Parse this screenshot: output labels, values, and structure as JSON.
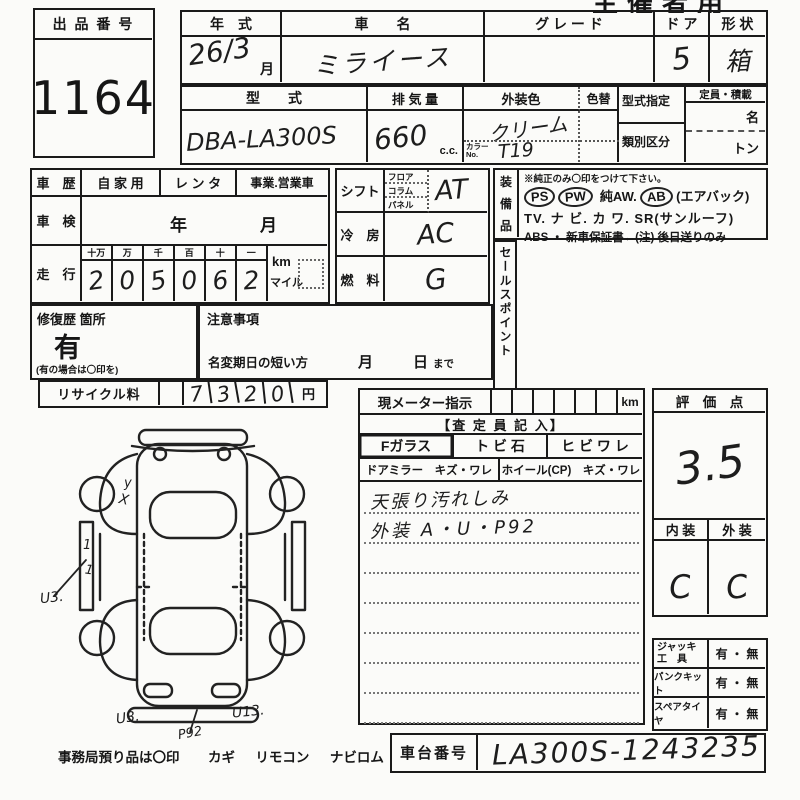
{
  "corner": {
    "label": "主催者用"
  },
  "lot": {
    "label": "出 品 番 号",
    "number": "1164"
  },
  "head": {
    "year_label": "年　式",
    "year_value": "26/3",
    "month_suffix": "月",
    "name_label": "車　　名",
    "name_value": "ミライース",
    "grade_label": "グ レ ー ド",
    "grade_value": "",
    "door_label": "ド ア",
    "door_value": "5",
    "shape_label": "形 状",
    "shape_value": "箱",
    "model_label": "型　　式",
    "model_value": "DBA-LA300S",
    "disp_label": "排 気 量",
    "disp_value": "660",
    "disp_unit": "c.c.",
    "color_label": "外装色",
    "color_value": "クリーム",
    "color_no_label_1": "カラー",
    "color_no_label_2": "No.",
    "color_no_value": "T19",
    "color_change_label": "色替",
    "type_desig_label": "型式指定",
    "class_div_label": "類別区分",
    "capacity_label": "定員・積載",
    "capacity_name": "名",
    "capacity_ton": "トン"
  },
  "history": {
    "label": "車　歴",
    "private": "自 家 用",
    "rental": "レ ン タ",
    "business": "事業.営業車"
  },
  "inspection": {
    "label": "車　検",
    "year": "年",
    "month": "月"
  },
  "mileage": {
    "label": "走　行",
    "headers": [
      "十万",
      "万",
      "千",
      "百",
      "十",
      "一"
    ],
    "digits": [
      "2",
      "0",
      "5",
      "0",
      "6",
      "2"
    ],
    "unit_km": "km",
    "unit_mile": "マイル"
  },
  "shift": {
    "label": "シフト",
    "opt1": "フロア",
    "opt2": "コラム",
    "opt3": "パネル",
    "value": "AT"
  },
  "cooling": {
    "label": "冷　房",
    "value": "AC"
  },
  "fuel": {
    "label": "燃　料",
    "value": "G"
  },
  "equipment": {
    "c1": "装",
    "c2": "備",
    "c3": "品",
    "note": "※純正のみ〇印をつけて下さい。",
    "ps": "PS",
    "pw": "PW",
    "aw": "純AW.",
    "ab": "AB",
    "ab_suffix": "(エアバック)",
    "line2": "TV. ナ ビ. カ ワ. SR(サンルーフ)",
    "line3": "ABS ・ 新車保証書←(注) 後日送りのみ"
  },
  "sales_point": {
    "label": "セールスポイント"
  },
  "repair": {
    "label": "修復歴 箇所",
    "value": "有",
    "note": "(有の場合は〇印を)"
  },
  "caution": {
    "label": "注意事項",
    "deadline": "名変期日の短い方",
    "month": "月",
    "day": "日",
    "until": "まで"
  },
  "recycle": {
    "label": "リサイクル料",
    "d1": "7",
    "d2": "3",
    "d3": "2",
    "d4": "0",
    "unit": "円"
  },
  "meter": {
    "label": "現メーター指示",
    "unit": "km"
  },
  "assessor": {
    "header": "【査 定 員 記 入】",
    "f_glass": "Fガラス",
    "stone": "ト ビ 石",
    "crack": "ヒ ビ ワ レ",
    "mirror": "ドアミラー　キズ・ワレ",
    "wheel": "ホイール(CP)　キズ・ワレ",
    "note1": "天張り汚れしみ",
    "note2": "外装 A・U・P92"
  },
  "score": {
    "label": "評　価　点",
    "value": "3.5",
    "interior_label": "内 装",
    "exterior_label": "外 装",
    "interior": "C",
    "exterior": "C"
  },
  "accessories": {
    "jack_l1": "ジャッキ",
    "jack_l2": "工　具",
    "puncture": "パンクキット",
    "spare": "スペアタイヤ",
    "yesno": "有 ・ 無"
  },
  "chassis": {
    "label": "車台番号",
    "value": "LA300S-1243235"
  },
  "office": {
    "label": "事務局預り品は〇印",
    "item1": "カギ",
    "item2": "リモコン",
    "item3": "ナビロム"
  },
  "diagram": {
    "mark_y": "y",
    "mark_x": "X",
    "tick1": "1",
    "tick2": "1",
    "u3_left": "U3.",
    "u3_bottom": "U3.",
    "p92": "P92",
    "u13": "U13."
  }
}
